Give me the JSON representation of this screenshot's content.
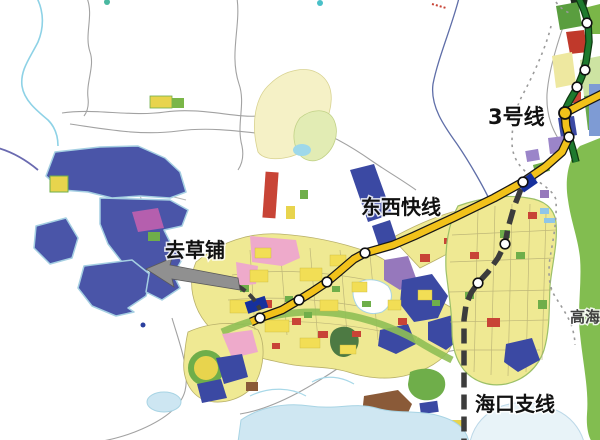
{
  "map": {
    "background_color": "#ffffff",
    "labels": {
      "line3": "3号线",
      "east_west_express": "东西快线",
      "to_caopu": "去草铺",
      "haikou_branch": "海口支线",
      "right_edge_partial": "高海"
    },
    "transit_lines": [
      {
        "id": "line-3",
        "name": "3号线",
        "color": "#1e7a2e",
        "casing": "#0e3a10",
        "width": 5,
        "style": "solid",
        "path": "M578,-4 L584,10 L588,22 L589,42 L586,62 L582,76 L577,88 L570,100 L565,110 L565,122 L567,131 L569,137 L573,150 L576,162",
        "stations": [
          [
            587,
            23
          ],
          [
            585,
            70
          ],
          [
            577,
            87
          ]
        ]
      },
      {
        "id": "east-west-express",
        "name": "东西快线",
        "color": "#f2c21a",
        "casing": "#161616",
        "width": 6.5,
        "style": "solid",
        "path": "M602,94 L582,104 L565,113 L566,126 L569,137 L562,152 L545,167 L523,182 L494,198 L455,217 L414,236 L393,245 L365,253 L354,259 L340,271 L327,282 L312,292 L299,300 L282,310 L260,318 L251,322",
        "stations": [
          [
            569,
            137
          ],
          [
            523,
            182
          ],
          [
            365,
            253
          ],
          [
            327,
            282
          ],
          [
            299,
            300
          ],
          [
            260,
            318
          ]
        ],
        "junction": [
          565,
          113
        ]
      },
      {
        "id": "haikou-branch",
        "name": "海口支线",
        "color": "#3c3c3c",
        "casing": null,
        "width": 5.5,
        "style": "dashed",
        "dash": "15 7",
        "path": "M521,189 L514,207 L508,228 L505,244 L498,258 L488,272 L478,283 L471,293 L466,305 L464,320 L464,350 L464,444",
        "stations": [
          [
            505,
            244
          ],
          [
            478,
            283
          ]
        ]
      }
    ],
    "stations_style": {
      "fill": "#ffffff",
      "stroke": "#111111",
      "radius": 4.8
    },
    "direction_arrow": {
      "label": "去草铺",
      "color": "#909090"
    },
    "terrain_colors": {
      "district_blue": "#4a55a8",
      "urban_yellow": "#efe993",
      "water": "#cfe7f2",
      "green_strip": "#82bd50",
      "pink": "#eeaacb",
      "red": "#c84436",
      "purple": "#9678bc",
      "royal_blue": "#3b49a3",
      "brown": "#8a5a38",
      "road_gray": "#a2a2a2"
    }
  }
}
